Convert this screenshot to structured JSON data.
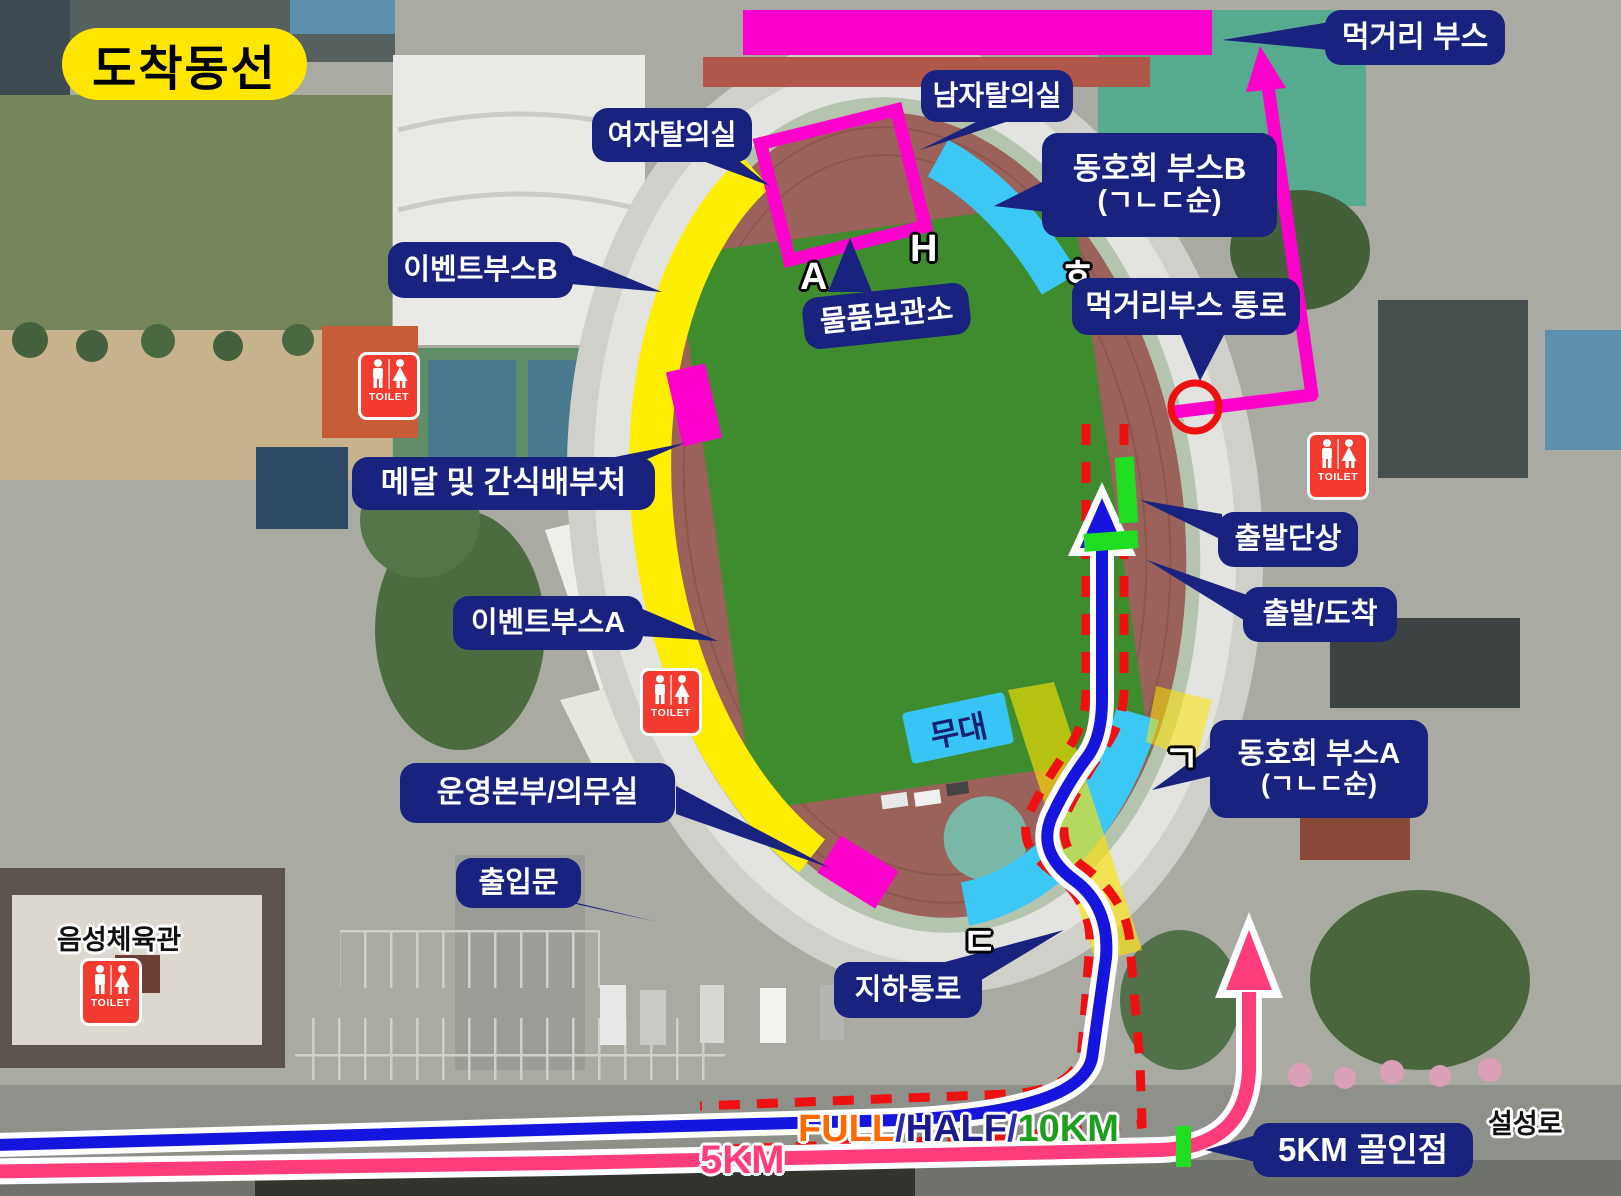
{
  "title": "도착동선",
  "callouts": {
    "food_booth": "먹거리 부스",
    "mens_changing": "남자탈의실",
    "womens_changing": "여자탈의실",
    "club_booth_b_line1": "동호회 부스B",
    "club_booth_b_line2": "(ㄱㄴㄷ순)",
    "event_booth_b": "이벤트부스B",
    "storage": "물품보관소",
    "food_booth_passage": "먹거리부스 통로",
    "medal_snack": "메달 및 간식배부처",
    "start_podium": "출발단상",
    "start_finish": "출발/도착",
    "event_booth_a": "이벤트부스A",
    "club_booth_a_line1": "동호회 부스A",
    "club_booth_a_line2": "(ㄱㄴㄷ순)",
    "hq_medical": "운영본부/의무실",
    "gate": "출입문",
    "underpass": "지하통로",
    "finish_5km": "5KM 골인점"
  },
  "stage_label": "무대",
  "place_labels": {
    "gym": "음성체육관",
    "road": "설성로"
  },
  "track_letters": {
    "a": "A",
    "h": "H",
    "hieut": "ㅎ",
    "giyeok": "ㄱ",
    "digeut": "ㄷ"
  },
  "route_labels": {
    "full": "FULL",
    "sep1": "/",
    "half": "HALF",
    "sep2": "/",
    "tenkm": "10KM",
    "fivekm": "5KM"
  },
  "toilet_label": "TOILET",
  "colors": {
    "callout_bg": "#1a2280",
    "title_bg": "#ffe600",
    "booth_magenta": "#ff00cc",
    "event_booth_yellow": "#ffee00",
    "club_booth_cyan": "#3cc8f5",
    "marker_green": "#21dd21",
    "route_full_half_10km_line": "#1515dd",
    "route_5km_line": "#ff3d7a",
    "route_dashed": "#ee1111",
    "full_text": "#ff6a00",
    "half_text": "#1b1b8f",
    "tenkm_text": "#1d9e1d"
  }
}
